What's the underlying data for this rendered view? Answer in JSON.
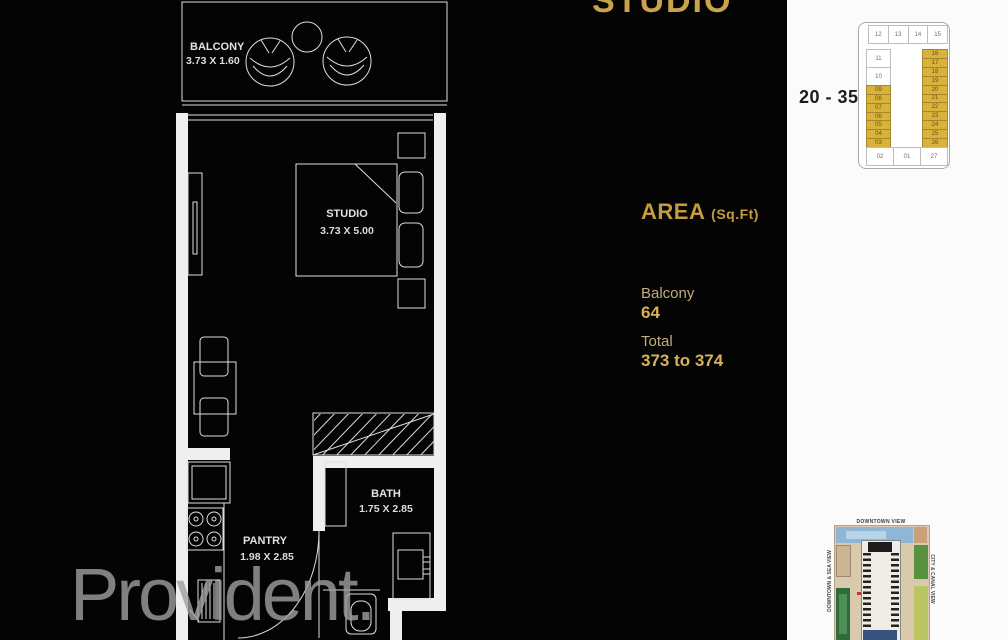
{
  "title": "STUDIO",
  "floor_range": "20 - 35",
  "watermark": "Provident.",
  "area": {
    "heading": "AREA",
    "unit": "(Sq.Ft)",
    "balcony_label": "Balcony",
    "balcony_value": "64",
    "total_label": "Total",
    "total_value": "373 to 374"
  },
  "floor_plan": {
    "rooms": [
      {
        "name": "BALCONY",
        "dims": "3.73 X 1.60"
      },
      {
        "name": "STUDIO",
        "dims": "3.73 X 5.00"
      },
      {
        "name": "BATH",
        "dims": "1.75 X 2.85"
      },
      {
        "name": "PANTRY",
        "dims": "1.98 X 2.85"
      }
    ]
  },
  "key_plan": {
    "top_row": [
      "12",
      "13",
      "14",
      "15"
    ],
    "left_white": [
      "11",
      "10"
    ],
    "left_gold": [
      "09",
      "08",
      "07",
      "06",
      "05",
      "04",
      "03"
    ],
    "right_gold": [
      "16",
      "17",
      "18",
      "19",
      "20",
      "21",
      "22",
      "23",
      "24",
      "25",
      "26"
    ],
    "bottom_row": [
      "02",
      "01",
      "27"
    ]
  },
  "site_map": {
    "top_label": "DOWNTOWN VIEW",
    "left_label": "DOWNTOWN & SEA VIEW",
    "right_label": "CITY & CANAL VIEW"
  },
  "colors": {
    "gold-title": "#c9a24b",
    "gold-heading": "#c59c3c",
    "gold-label": "#c2ad7c",
    "gold-value": "#d8b258",
    "gold-cell": "#d9b23c"
  }
}
